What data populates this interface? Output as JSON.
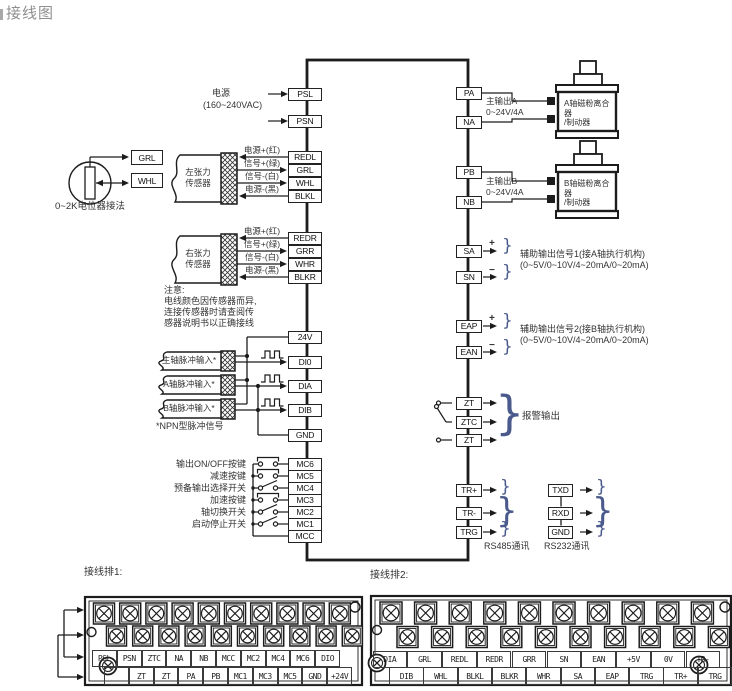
{
  "title": "接线图",
  "colors": {
    "line": "#1c1c1c",
    "text": "#333333",
    "brace": "#4a5a8c"
  },
  "icons": {
    "brace": "}",
    "plus": "+",
    "minus": "−"
  },
  "main_unit": {
    "left_terminals": [
      "PSL",
      "PSN",
      "REDL",
      "GRL",
      "WHL",
      "BLKL",
      "REDR",
      "GRR",
      "WHR",
      "BLKR",
      "24V",
      "DI0",
      "DIA",
      "DIB",
      "GND",
      "MC6",
      "MC5",
      "MC4",
      "MC3",
      "MC2",
      "MC1",
      "MCC"
    ],
    "right_terminals": [
      "PA",
      "NA",
      "PB",
      "NB",
      "SA",
      "SN",
      "EAP",
      "EAN",
      "ZT",
      "ZTC",
      "ZT",
      "TR+",
      "TR-",
      "TRG"
    ],
    "rs232_terminals": [
      "TXD",
      "RXD",
      "GND"
    ]
  },
  "power": {
    "label_line1": "电源",
    "label_line2": "(160~240VAC)"
  },
  "potentiometer": {
    "terminals": [
      "GRL",
      "WHL"
    ],
    "caption": "0~2K电位器接法"
  },
  "sensors": {
    "left": {
      "name_line1": "左张力",
      "name_line2": "传感器",
      "wires": [
        "电源+(红)",
        "信号+(绿)",
        "信号-(白)",
        "电源-(黑)"
      ]
    },
    "right": {
      "name_line1": "右张力",
      "name_line2": "传感器",
      "wires": [
        "电源+(红)",
        "信号+(绿)",
        "信号-(白)",
        "电源-(黑)"
      ]
    },
    "note": [
      "注意:",
      "电线颜色因传感器而异,",
      "连接传感器时请查阅传",
      "感器说明书以正确接线"
    ]
  },
  "pulse_inputs": {
    "cables": [
      "主轴脉冲输入*",
      "A轴脉冲输入*",
      "B轴脉冲输入*"
    ],
    "note": "*NPN型脉冲信号"
  },
  "switches": {
    "labels": [
      "输出ON/OFF按键",
      "减速按键",
      "预备输出选择开关",
      "加速按键",
      "轴切换开关",
      "启动停止开关"
    ]
  },
  "outputs": {
    "a": {
      "line1": "主输出A",
      "line2": "0~24V/4A",
      "device_line1": "A轴磁粉离合器",
      "device_line2": "/制动器"
    },
    "b": {
      "line1": "主输出B",
      "line2": "0~24V/4A",
      "device_line1": "B轴磁粉离合器",
      "device_line2": "/制动器"
    },
    "aux1": {
      "line1": "辅助输出信号1(接A轴执行机构)",
      "line2": "(0~5V/0~10V/4~20mA/0~20mA)"
    },
    "aux2": {
      "line1": "辅助输出信号2(接B轴执行机构)",
      "line2": "(0~5V/0~10V/4~20mA/0~20mA)"
    },
    "alarm": "报警输出",
    "rs485": "RS485通讯",
    "rs232": "RS232通讯"
  },
  "terminal_strips": {
    "strip1": {
      "title": "接线排1:",
      "top_row": [
        "PSL",
        "PSN",
        "ZTC",
        "NA",
        "NB",
        "MCC",
        "MC2",
        "MC4",
        "MC6",
        "DIO"
      ],
      "bottom_row": [
        "",
        "ZT",
        "ZT",
        "PA",
        "PB",
        "MC1",
        "MC3",
        "MC5",
        "GND",
        "+24V"
      ]
    },
    "strip2": {
      "title": "接线排2:",
      "top_row": [
        "DIA",
        "GRL",
        "REDL",
        "REDR",
        "GRR",
        "SN",
        "EAN",
        "+5V",
        "0V",
        "TR-"
      ],
      "bottom_row": [
        "DIB",
        "WHL",
        "BLKL",
        "BLKR",
        "WHR",
        "SA",
        "EAP",
        "TRG",
        "TR+",
        "TRG"
      ]
    }
  }
}
